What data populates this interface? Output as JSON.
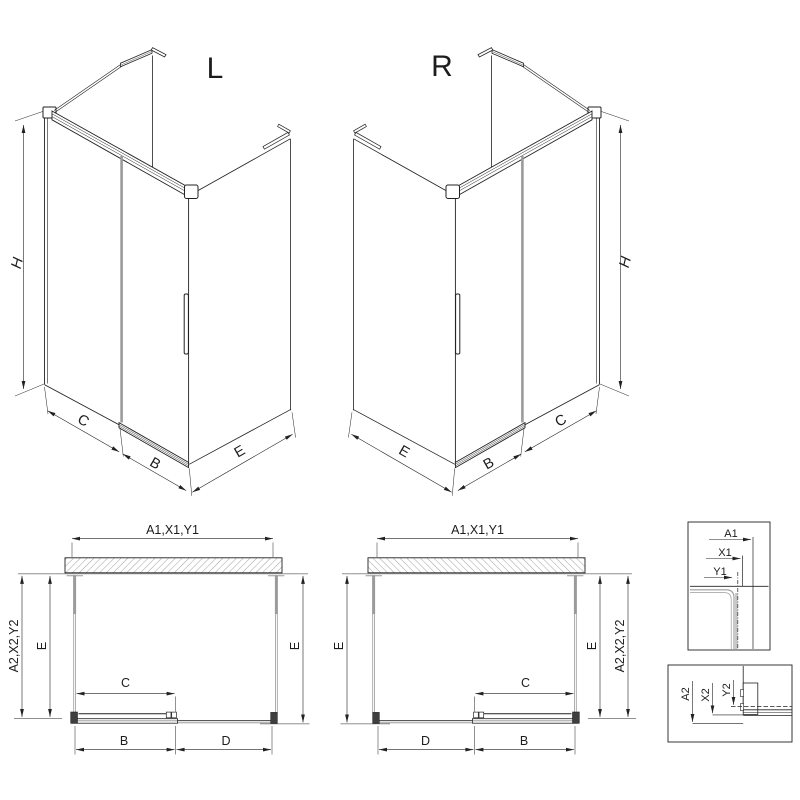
{
  "drawing": {
    "iso_l": {
      "label": "L",
      "dim_h": "H",
      "dim_c": "C",
      "dim_b": "B",
      "dim_e": "E"
    },
    "iso_r": {
      "label": "R",
      "dim_h": "H",
      "dim_c": "C",
      "dim_b": "B",
      "dim_e": "E"
    },
    "plan_l": {
      "dim_width_top": "A1,X1,Y1",
      "dim_depth_outer": "A2,X2,Y2",
      "dim_e_left": "E",
      "dim_e_right": "E",
      "dim_c": "C",
      "dim_b": "B",
      "dim_d": "D"
    },
    "plan_r": {
      "dim_width_top": "A1,X1,Y1",
      "dim_e_left": "E",
      "dim_e_right": "E",
      "dim_depth_outer": "A2,X2,Y2",
      "dim_c": "C",
      "dim_b": "B",
      "dim_d": "D"
    },
    "detail_wall_profile": {
      "dim_a1": "A1",
      "dim_x1": "X1",
      "dim_y1": "Y1"
    },
    "detail_track": {
      "dim_a2": "A2",
      "dim_x2": "X2",
      "dim_y2": "Y2"
    },
    "colors": {
      "line": "#222222",
      "glass": "#9b9b9b",
      "hatch": "#8c8c8c",
      "cap_fill": "#3f3f3f",
      "background": "#ffffff"
    }
  }
}
